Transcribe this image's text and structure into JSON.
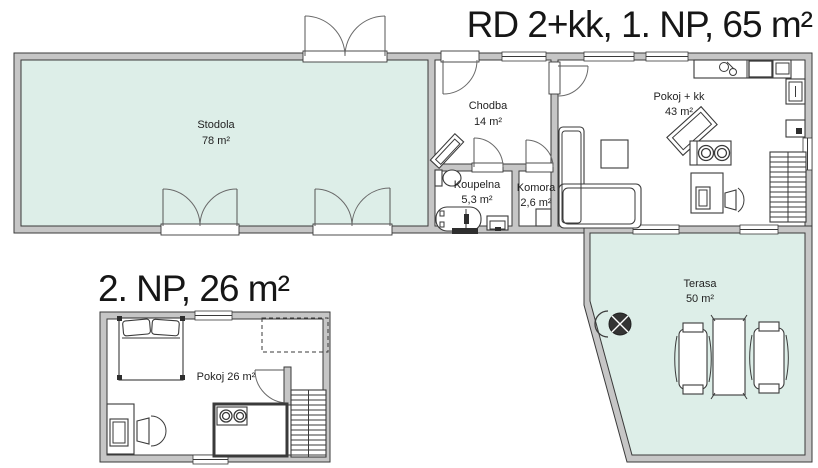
{
  "titles": {
    "floor1": "RD 2+kk, 1. NP, 65 m²",
    "floor2": "2. NP, 26 m²"
  },
  "rooms": {
    "stodola": {
      "name": "Stodola",
      "area": "78 m²"
    },
    "chodba": {
      "name": "Chodba",
      "area": "14 m²"
    },
    "koupelna": {
      "name": "Koupelna",
      "area": "5,3 m²"
    },
    "komora": {
      "name": "Komora",
      "area": "2,6 m²"
    },
    "pokoj_kk": {
      "name": "Pokoj + kk",
      "area": "43 m²"
    },
    "terasa": {
      "name": "Terasa",
      "area": "50 m²"
    },
    "pokoj2": {
      "label": "Pokoj 26 m²"
    }
  },
  "colors": {
    "room_fill": "#ddeee8",
    "wall_fill": "#c6c6c6",
    "line": "#3a3a3a",
    "background": "#ffffff",
    "text": "#1c1c1c"
  }
}
